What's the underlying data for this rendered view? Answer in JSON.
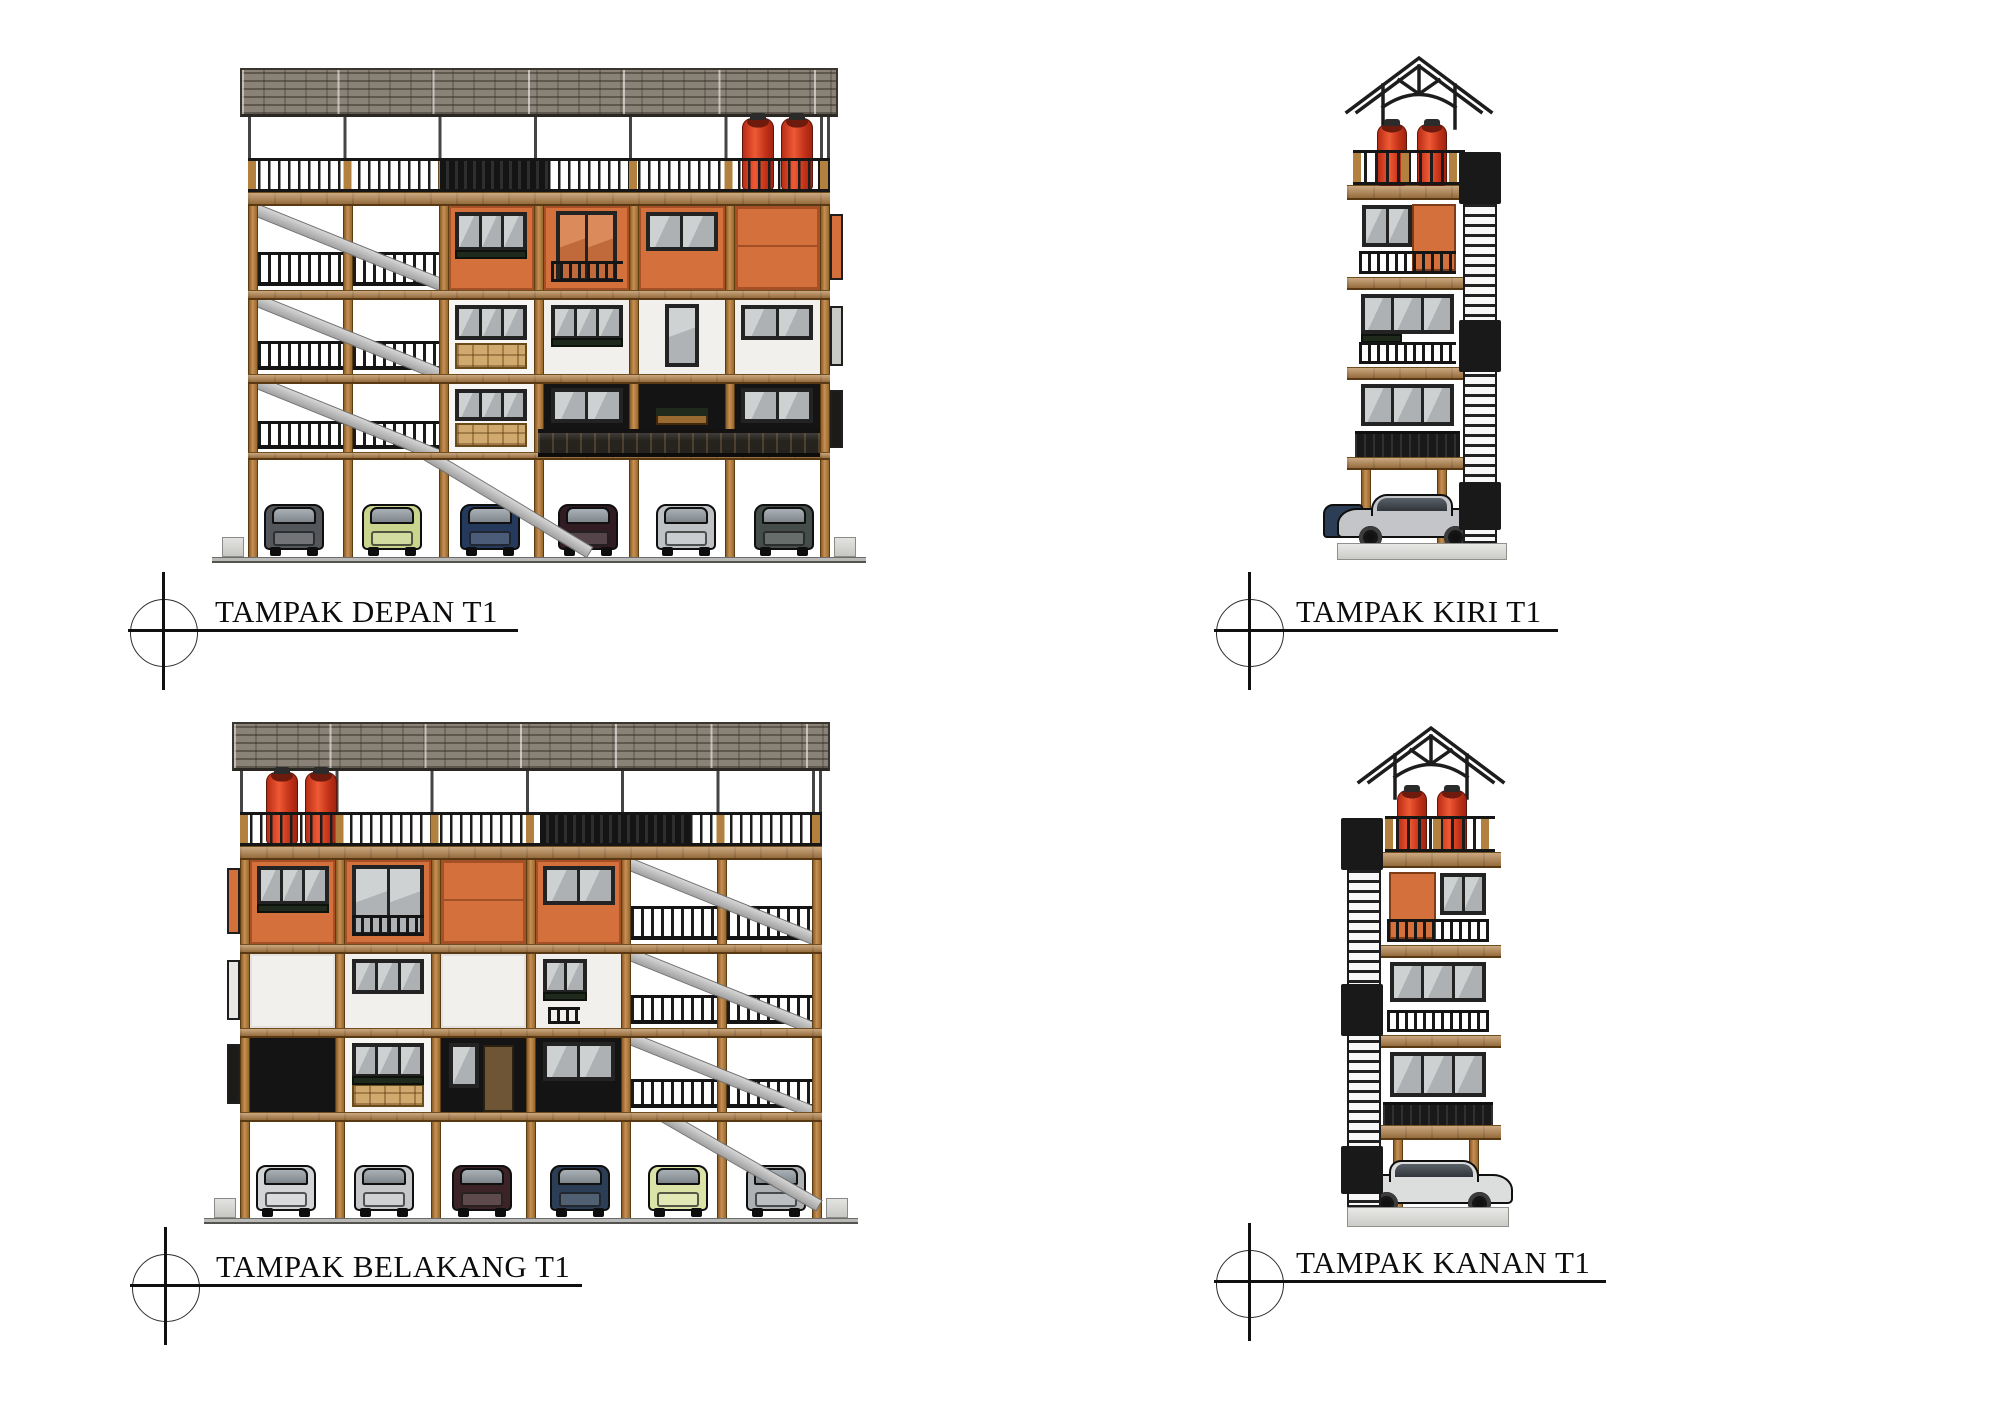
{
  "views": [
    {
      "id": "front",
      "label": "TAMPAK DEPAN T1"
    },
    {
      "id": "left",
      "label": "TAMPAK KIRI T1"
    },
    {
      "id": "back",
      "label": "TAMPAK BELAKANG T1"
    },
    {
      "id": "right",
      "label": "TAMPAK KANAN T1"
    }
  ],
  "palette": {
    "paper": "#ffffff",
    "wood": "#b3813f",
    "beam": "#b5834a",
    "roof": "#8a8276",
    "frame": "#232323",
    "orange": "#d4703c",
    "plaster": "#f1f0ec",
    "black-panel": "#141414",
    "railing": "#1c1c1c",
    "stair-steel": "#c4c4c4",
    "tank-red": "#d63a20",
    "concrete": "#d9d9d7",
    "lattice": "#cfa96e",
    "planter-green": "#202a1c",
    "balcony-dark": "#26221d",
    "ink": "#111111"
  },
  "cars": {
    "front_row": [
      "#53565b",
      "#c9d58d",
      "#24395b",
      "#301c22",
      "#bfc2c5",
      "#454d4b"
    ],
    "back_row": [
      "#d2d4d5",
      "#c5c7c9",
      "#3b2327",
      "#2c3d56",
      "#dce3a7",
      "#aeb1b4"
    ],
    "left_side": "#c3c5c8",
    "left_side_peek": "#2c3d56",
    "right_side": "#dcdddd"
  },
  "equipment": {
    "water_tanks_per_view": 2,
    "floors_above_parking": 3,
    "parking_bays": 6
  }
}
